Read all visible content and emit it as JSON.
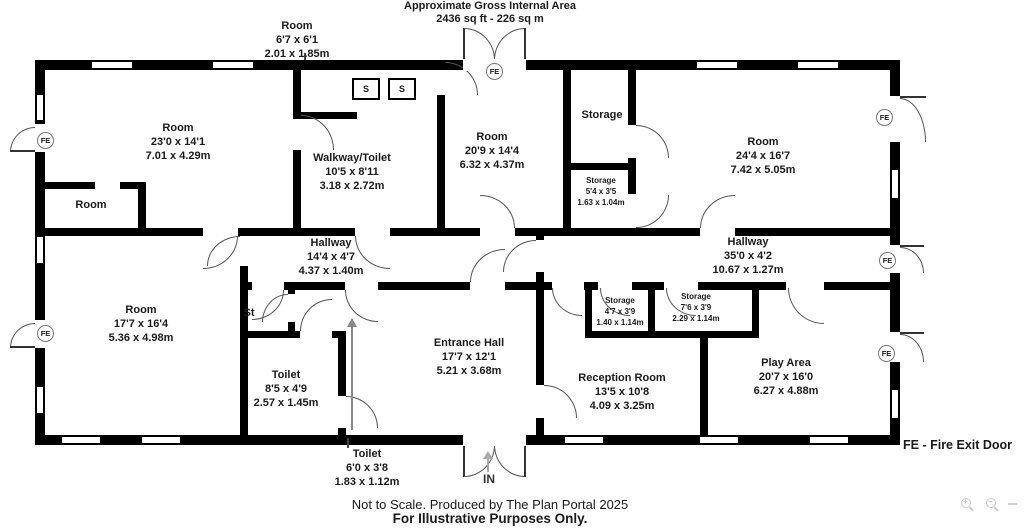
{
  "header": {
    "line1": "Approximate Gross Internal Area",
    "line2": "2436 sq ft - 226 sq m"
  },
  "rooms": {
    "top_room": {
      "name": "Room",
      "imperial": "6'7 x 6'1",
      "metric": "2.01 x 1.85m"
    },
    "room_23": {
      "name": "Room",
      "imperial": "23'0 x 14'1",
      "metric": "7.01 x 4.29m"
    },
    "walkway": {
      "name": "Walkway/Toilet",
      "imperial": "10'5 x 8'11",
      "metric": "3.18 x 2.72m"
    },
    "room_20": {
      "name": "Room",
      "imperial": "20'9 x 14'4",
      "metric": "6.32 x 4.37m"
    },
    "storage_top": {
      "name": "Storage"
    },
    "storage_54": {
      "name": "Storage",
      "imperial": "5'4 x 3'5",
      "metric": "1.63 x 1.04m"
    },
    "room_24": {
      "name": "Room",
      "imperial": "24'4 x 16'7",
      "metric": "7.42 x 5.05m"
    },
    "small_room": {
      "name": "Room"
    },
    "hallway_14": {
      "name": "Hallway",
      "imperial": "14'4 x 4'7",
      "metric": "4.37 x 1.40m"
    },
    "hallway_35": {
      "name": "Hallway",
      "imperial": "35'0 x 4'2",
      "metric": "10.67 x 1.27m"
    },
    "room_17": {
      "name": "Room",
      "imperial": "17'7 x 16'4",
      "metric": "5.36 x 4.98m"
    },
    "st": {
      "name": "St"
    },
    "toilet_85": {
      "name": "Toilet",
      "imperial": "8'5 x 4'9",
      "metric": "2.57 x 1.45m"
    },
    "entrance_hall": {
      "name": "Entrance Hall",
      "imperial": "17'7 x 12'1",
      "metric": "5.21 x 3.68m"
    },
    "storage_47": {
      "name": "Storage",
      "imperial": "4'7 x 3'9",
      "metric": "1.40 x 1.14m"
    },
    "storage_76": {
      "name": "Storage",
      "imperial": "7'6 x 3'9",
      "metric": "2.29 x 1.14m"
    },
    "reception": {
      "name": "Reception Room",
      "imperial": "13'5 x 10'8",
      "metric": "4.09 x 3.25m"
    },
    "play_area": {
      "name": "Play Area",
      "imperial": "20'7 x 16'0",
      "metric": "6.27 x 4.88m"
    },
    "toilet_60": {
      "name": "Toilet",
      "imperial": "6'0 x 3'8",
      "metric": "1.83 x 1.12m"
    }
  },
  "markers": {
    "fe": "FE",
    "sink": "S",
    "entrance": "IN"
  },
  "legend": {
    "fire_exit": "FE - Fire Exit Door"
  },
  "footer": {
    "line1": "Not to Scale. Produced by The Plan Portal 2025",
    "line2": "For Illustrative Purposes Only."
  },
  "colors": {
    "wall": "#000000",
    "background": "#ffffff",
    "door_arc": "#555555",
    "fe_circle_border": "#777777",
    "viewer_controls": "#c9c9c9"
  }
}
